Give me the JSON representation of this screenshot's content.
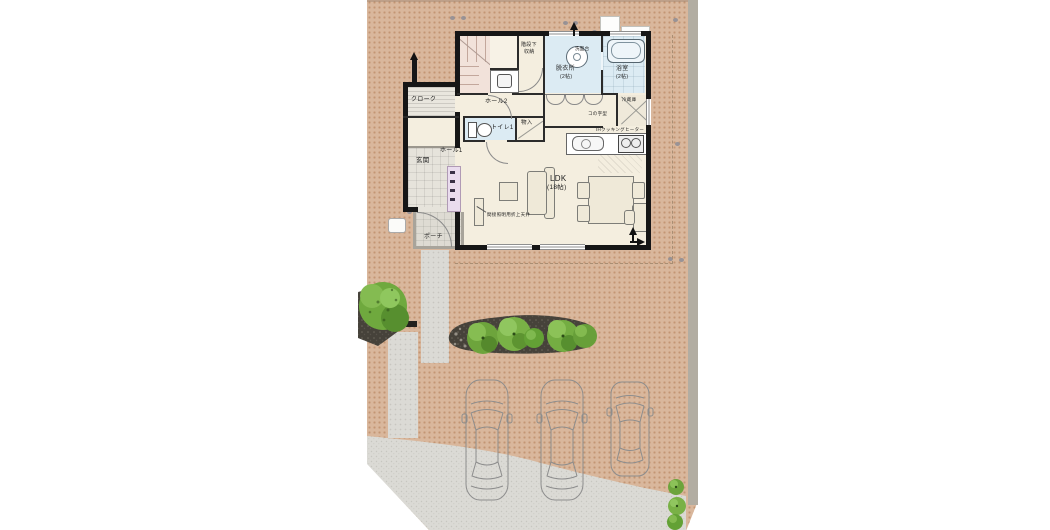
{
  "site": {
    "colors": {
      "ground": "#d9b79c",
      "ground_dot": "#c39673",
      "concrete": "#dbdad5",
      "border_strip": "#b2ada2",
      "planting_soil": "#46423a",
      "tree_green": "#6fa93e",
      "wall": "#161616",
      "floor": "#f4eedf",
      "wet_room": "#dcebf3",
      "stairs": "#f2e2da",
      "entry_tile": "#e6e3db",
      "shoe_cabinet": "#eadcee"
    }
  },
  "floorplan": {
    "labels": {
      "under_stairs_line1": "階段下",
      "under_stairs_line2": "収納",
      "washstand": "洗面台",
      "dressing_name": "脱衣所",
      "dressing_size": "(2帖)",
      "bath_name": "浴室",
      "bath_size": "(2帖)",
      "fridge": "冷蔵庫",
      "closet_note": "コの字型",
      "ih_heater": "IHクッキングヒーター",
      "cloak": "クローク",
      "hall2": "ホール2",
      "toilet1": "トイレ1",
      "storage": "物入",
      "hall1": "ホール1",
      "entrance": "玄関",
      "porch": "ポーチ",
      "ldk_name": "LDK",
      "ldk_size": "(18帖)",
      "ceiling_note": "間接照明用折上天井"
    }
  }
}
